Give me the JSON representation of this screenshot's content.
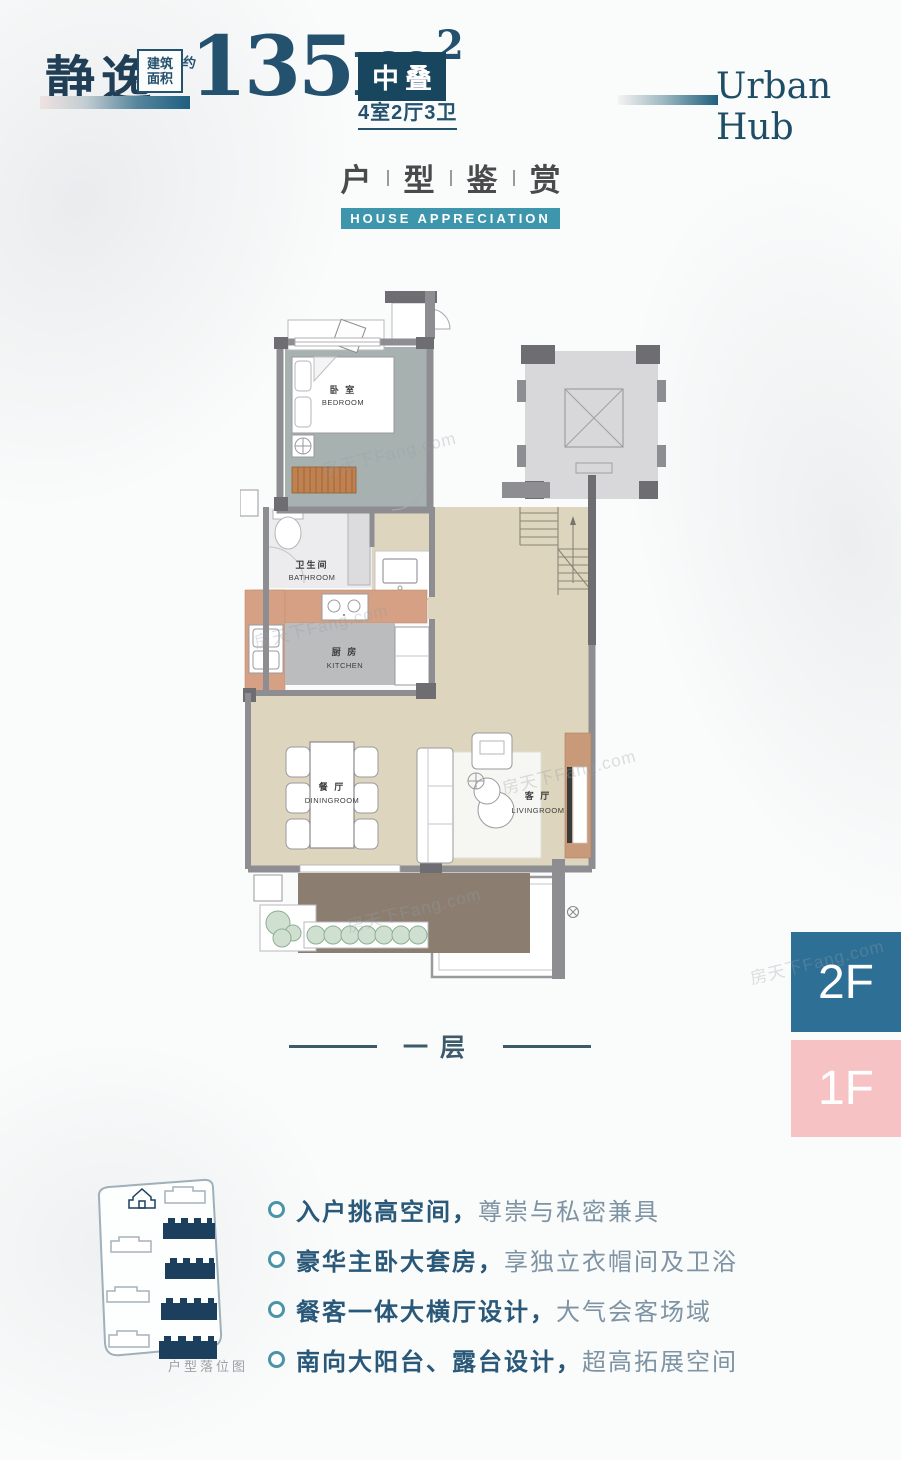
{
  "header": {
    "name": "静逸",
    "area_label_top": "建筑",
    "area_label_bottom": "面积",
    "area_approx": "约",
    "area_value": "135m",
    "area_exponent": "2",
    "type_badge": "中叠",
    "rooms_summary": "4室2厅3卫",
    "brand": "Urban Hub"
  },
  "section": {
    "title_chars": [
      "户",
      "型",
      "鉴",
      "赏"
    ],
    "subtitle": "HOUSE APPRECIATION"
  },
  "floorplan": {
    "bedroom_zh": "卧 室",
    "bedroom_en": "BEDROOM",
    "bathroom_zh": "卫生间",
    "bathroom_en": "BATHROOM",
    "kitchen_zh": "厨 房",
    "kitchen_en": "KITCHEN",
    "dining_zh": "餐 厅",
    "dining_en": "DININGROOM",
    "living_zh": "客 厅",
    "living_en": "LIVINGROOM",
    "caption": "一层"
  },
  "floor_selector": {
    "upper": "2F",
    "lower": "1F"
  },
  "siteplan": {
    "label": "户型落位图"
  },
  "features": [
    {
      "bold": "入户挑高空间，",
      "light": "尊崇与私密兼具"
    },
    {
      "bold": "豪华主卧大套房，",
      "light": "享独立衣帽间及卫浴"
    },
    {
      "bold": "餐客一体大横厅设计，",
      "light": "大气会客场域"
    },
    {
      "bold": "南向大阳台、露台设计，",
      "light": "超高拓展空间"
    }
  ],
  "watermark": "房天下Fang.com",
  "colors": {
    "dark_navy": "#17465e",
    "text_dark": "#24516e",
    "accent_teal": "#3e96ad",
    "floor2_bg": "#2e6f95",
    "floor1_bg": "#f6c2c3",
    "feature_bold": "#2a5878",
    "feature_light": "#7e93a3",
    "wall_gray": "#8e8e92",
    "floor_tan": "#ddd5bd",
    "bedroom_floor": "#a7b2b0",
    "balcony_brown": "#8b7e70"
  }
}
